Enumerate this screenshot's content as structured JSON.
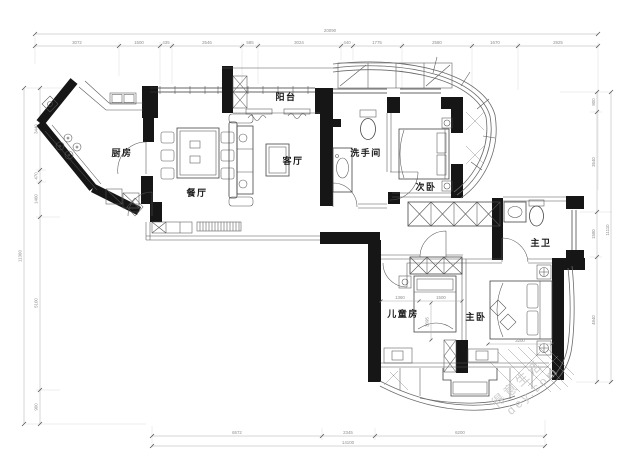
{
  "plan": {
    "rooms": {
      "balcony": "阳台",
      "kitchen": "厨房",
      "dining": "餐厅",
      "living": "客厅",
      "washroom": "洗手间",
      "second_bedroom": "次卧",
      "master_bath": "主卫",
      "master_bedroom": "主卧",
      "kids_room": "儿童房"
    },
    "dims": {
      "top": {
        "total": "20090",
        "segments": [
          "3072",
          "1500",
          "435",
          "2546",
          "585",
          "3024",
          "440",
          "1775",
          "2580",
          "1670",
          "2925"
        ]
      },
      "bottom": {
        "total": "14100",
        "segments": [
          "6572",
          "2345",
          "6200"
        ]
      },
      "left": {
        "total": "11360",
        "segments": [
          "3440",
          "470",
          "1460",
          "5100",
          "900"
        ]
      },
      "right": {
        "total": "11110",
        "segments": [
          "800",
          "3540",
          "1580",
          "4840"
        ]
      },
      "interior": {
        "kids_left": "1360",
        "kids_right": "1500",
        "kids_depth": "3095",
        "master_bed": "3200"
      }
    },
    "watermark": {
      "line1": "得意生活",
      "line2": "dey.com"
    },
    "colors": {
      "wall": "#161616",
      "thin_line": "#555555",
      "dim_text": "#8f8f8f",
      "watermark": "#c6c6c6"
    }
  }
}
